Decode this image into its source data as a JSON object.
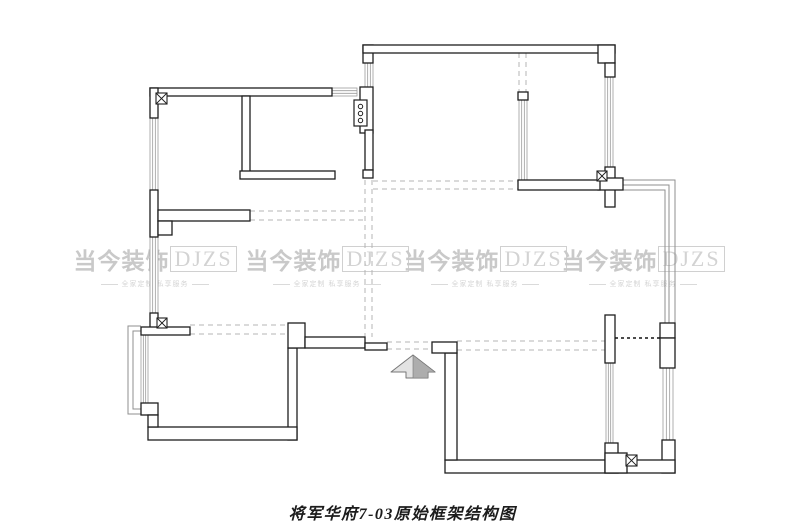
{
  "page": {
    "width": 805,
    "height": 532,
    "background": "#ffffff"
  },
  "caption": {
    "text": "将军华府7-03原始框架结构图"
  },
  "watermark": {
    "brand_cn": "当今装饰",
    "brand_en": "DJZS",
    "tagline": "全家定制 私享服务",
    "color": "#c9c9c9",
    "positions": [
      {
        "x": 80,
        "y": 242
      },
      {
        "x": 252,
        "y": 242
      },
      {
        "x": 410,
        "y": 242
      },
      {
        "x": 568,
        "y": 242
      }
    ]
  },
  "plan": {
    "colors": {
      "wall_stroke": "#1e1e1e",
      "wall_fill": "#ffffff",
      "window_stroke": "#9c9c9c",
      "dashed": "#b5b5b5",
      "balcony": "#8f8f8f",
      "dotted_door": "#111111",
      "arrow_light": "#e3e3e3",
      "arrow_dark": "#adadad"
    },
    "walls": [
      [
        150,
        88,
        182,
        8
      ],
      [
        242,
        96,
        8,
        77
      ],
      [
        240,
        171,
        95,
        8
      ],
      [
        150,
        88,
        8,
        30
      ],
      [
        150,
        190,
        8,
        47
      ],
      [
        150,
        313,
        8,
        19
      ],
      [
        158,
        210,
        92,
        11
      ],
      [
        158,
        221,
        14,
        14
      ],
      [
        141,
        327,
        49,
        8
      ],
      [
        363,
        45,
        10,
        18
      ],
      [
        363,
        45,
        252,
        8
      ],
      [
        598,
        45,
        17,
        18
      ],
      [
        605,
        63,
        10,
        14
      ],
      [
        360,
        87,
        13,
        46
      ],
      [
        365,
        130,
        8,
        40
      ],
      [
        363,
        170,
        10,
        8
      ],
      [
        605,
        167,
        10,
        40
      ],
      [
        598,
        178,
        25,
        12
      ],
      [
        518,
        92,
        10,
        8
      ],
      [
        518,
        180,
        82,
        10
      ],
      [
        605,
        315,
        10,
        48
      ],
      [
        660,
        323,
        15,
        15
      ],
      [
        660,
        338,
        15,
        30
      ],
      [
        662,
        440,
        13,
        33
      ],
      [
        445,
        460,
        230,
        13
      ],
      [
        605,
        443,
        13,
        30
      ],
      [
        605,
        453,
        22,
        20
      ],
      [
        445,
        353,
        12,
        107
      ],
      [
        432,
        342,
        25,
        11
      ],
      [
        288,
        348,
        9,
        92
      ],
      [
        288,
        323,
        17,
        25
      ],
      [
        305,
        337,
        60,
        11
      ],
      [
        365,
        343,
        22,
        7
      ],
      [
        148,
        427,
        149,
        13
      ],
      [
        141,
        403,
        17,
        12
      ],
      [
        148,
        415,
        10,
        12
      ]
    ],
    "windows": [
      {
        "x": 150,
        "y": 118,
        "w": 8,
        "h": 72,
        "dir": "v"
      },
      {
        "x": 150,
        "y": 237,
        "w": 8,
        "h": 76,
        "dir": "v"
      },
      {
        "x": 332,
        "y": 88,
        "w": 25,
        "h": 8,
        "dir": "h"
      },
      {
        "x": 365,
        "y": 63,
        "w": 8,
        "h": 24,
        "dir": "v"
      },
      {
        "x": 605,
        "y": 77,
        "w": 8,
        "h": 90,
        "dir": "v"
      },
      {
        "x": 519,
        "y": 100,
        "w": 8,
        "h": 80,
        "dir": "v"
      },
      {
        "x": 606,
        "y": 363,
        "w": 7,
        "h": 80,
        "dir": "v"
      },
      {
        "x": 663,
        "y": 368,
        "w": 10,
        "h": 72,
        "dir": "v"
      },
      {
        "x": 141,
        "y": 335,
        "w": 7,
        "h": 68,
        "dir": "v"
      }
    ],
    "dashed_lines": [
      [
        373,
        181,
        518,
        181
      ],
      [
        373,
        189,
        518,
        189
      ],
      [
        365,
        180,
        365,
        337
      ],
      [
        372,
        180,
        372,
        337
      ],
      [
        250,
        211,
        365,
        211
      ],
      [
        250,
        220,
        365,
        220
      ],
      [
        190,
        325,
        288,
        325
      ],
      [
        190,
        334,
        288,
        334
      ],
      [
        457,
        341,
        605,
        341
      ],
      [
        457,
        350,
        605,
        350
      ],
      [
        387,
        342,
        432,
        342
      ],
      [
        387,
        349,
        432,
        349
      ],
      [
        519,
        53,
        519,
        92
      ],
      [
        526,
        53,
        526,
        92
      ]
    ],
    "dotted_door_line": [
      615,
      338,
      660,
      338
    ],
    "balcony_paths": [
      "M623,180 H675 V323",
      "M623,185 H669 V323",
      "M623,190 H665 V323",
      "M141,326 H128 V414 H141",
      "M141,331 H133 V409 H141"
    ],
    "column_markers": [
      [
        156,
        93,
        11
      ],
      [
        157,
        318,
        10
      ],
      [
        597,
        171,
        10
      ],
      [
        626,
        455,
        11
      ]
    ],
    "fixture": {
      "x": 354,
      "y": 100,
      "w": 13,
      "h": 26,
      "circles": [
        [
          360.5,
          106.5
        ],
        [
          360.5,
          113.5
        ],
        [
          360.5,
          120.5
        ]
      ],
      "r": 2.2
    },
    "entry_arrow": {
      "body": "391,372 413,355 435,372 428,372 428,378 406,378 406,372",
      "shade": "413,355 435,372 428,372 428,378 413,378"
    }
  }
}
